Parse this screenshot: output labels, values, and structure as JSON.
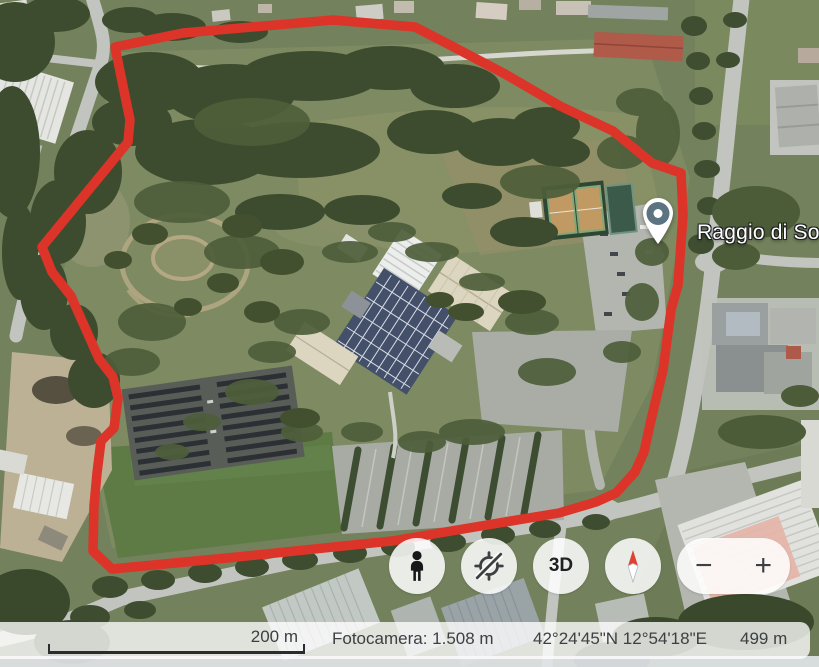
{
  "map": {
    "pin_label": "Raggio di So",
    "pin_color": "#5c7382",
    "polygon_color": "#dc3428"
  },
  "controls": {
    "pegman_icon": "pegman-street-view",
    "tilt_icon": "tilt-rotate-disabled",
    "threed_label": "3D",
    "compass_icon": "compass-north-up",
    "zoom_out_label": "−",
    "zoom_in_label": "+"
  },
  "status_bar": {
    "scale_label": "200 m",
    "camera_label": "Fotocamera: 1.508 m",
    "coordinates": "42°24'45\"N 12°54'18\"E",
    "altitude": "499 m"
  }
}
